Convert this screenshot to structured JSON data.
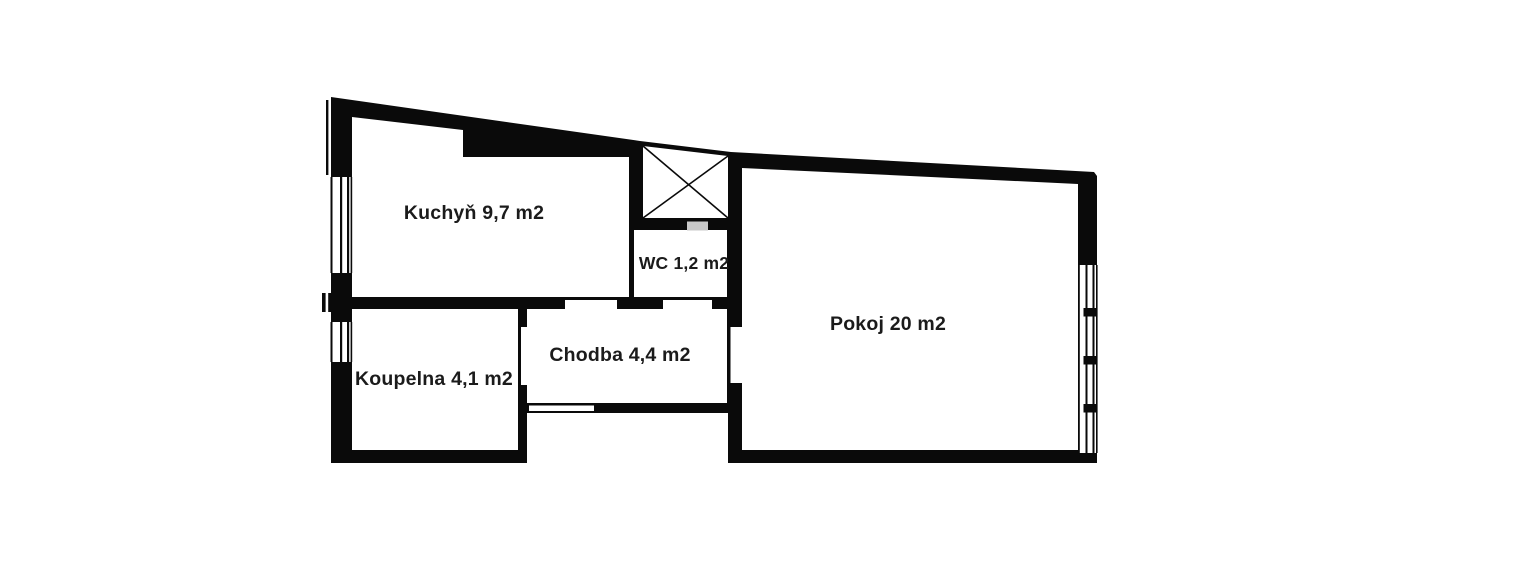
{
  "floorplan": {
    "rooms": [
      {
        "id": "kuchyn",
        "name": "Kuchyň",
        "area": "9,7 m2",
        "label": "Kuchyň 9,7 m2"
      },
      {
        "id": "wc",
        "name": "WC",
        "area": "1,2 m2",
        "label": "WC 1,2 m2"
      },
      {
        "id": "pokoj",
        "name": "Pokoj",
        "area": "20 m2",
        "label": "Pokoj 20 m2"
      },
      {
        "id": "koupelna",
        "name": "Koupelna",
        "area": "4,1 m2",
        "label": "Koupelna 4,1 m2"
      },
      {
        "id": "chodba",
        "name": "Chodba",
        "area": "4,4 m2",
        "label": "Chodba 4,4 m2"
      }
    ],
    "colors": {
      "wall": "#0a0a0a",
      "background": "#ffffff",
      "shaft_vent": "#c9c9c9",
      "label_text": "#1b1b1b"
    },
    "icons": {
      "shaft_cross": "diagonal-cross-box"
    }
  }
}
